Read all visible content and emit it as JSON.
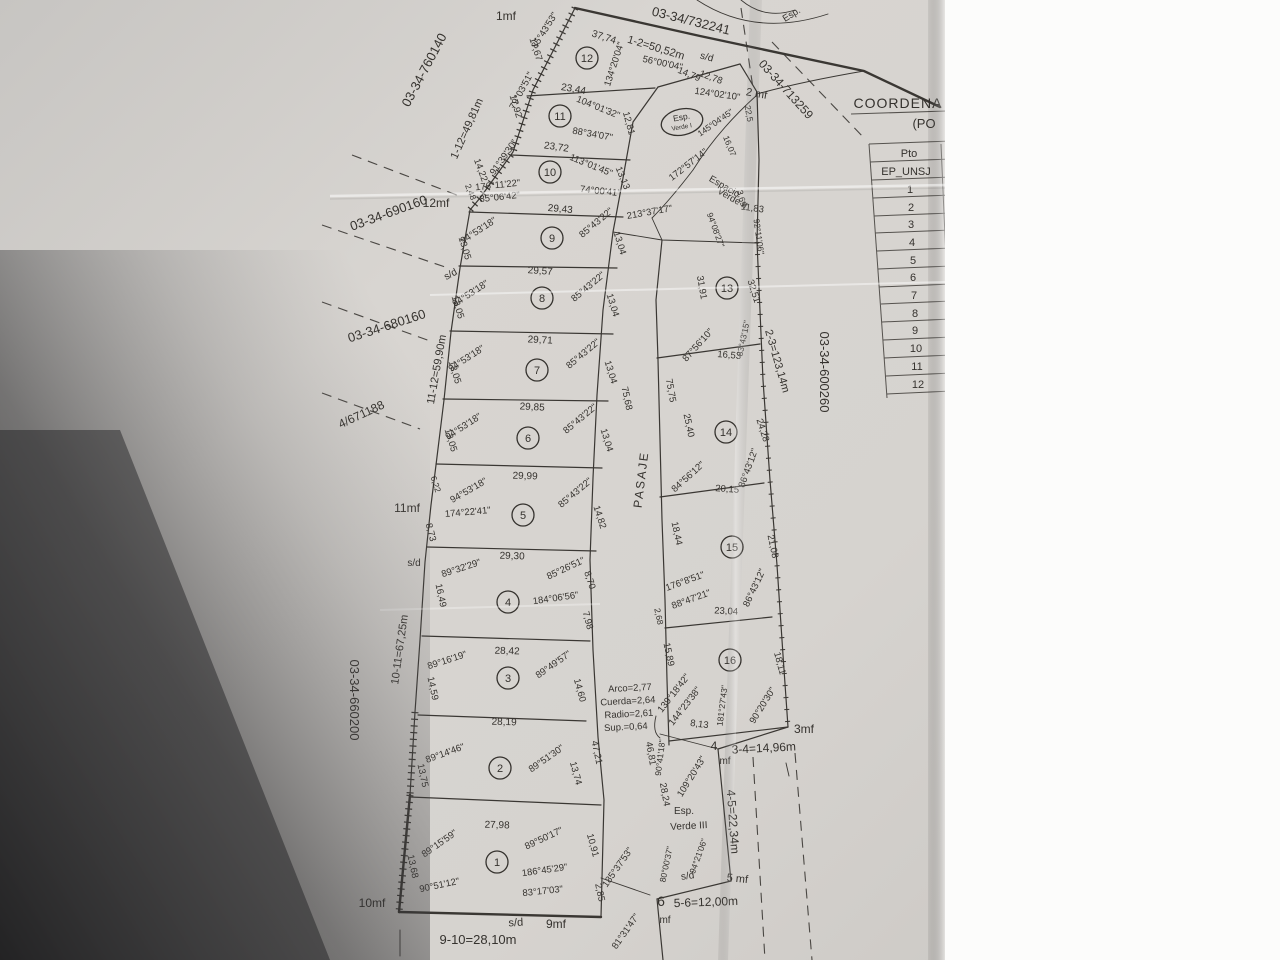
{
  "misc": {
    "sd": "s/d",
    "coord_title": "COORDENA",
    "coord_sub": "(PO",
    "pasaje": "PASAJE"
  },
  "parcels": {
    "top": "03-34/732241",
    "top_left": "03-34-760140",
    "left_a": "03-34-690160",
    "left_b": "03-34-680160",
    "left_c": "4/671188",
    "left_d": "03-34-660200",
    "right_a": "03-34-713259",
    "right_b": "03-34-600260"
  },
  "perimeter": {
    "s1_2": "1-2=50,52m",
    "s1_12": "1-12=49,81m",
    "s11_12": "11-12=59,90m",
    "s10_11": "10-11=67,25m",
    "s9_10": "9-10=28,10m",
    "s2_3": "2-3=123,14m",
    "s3_4": "3-4=14,96m",
    "s4_5": "4-5=22,34m",
    "s5_6": "5-6=12,00m"
  },
  "markers": {
    "m1": "1mf",
    "m2": "2 mf",
    "m3": "3mf",
    "m4a": "4",
    "m4b": "mf",
    "m5": "5 mf",
    "m6a": "6",
    "m6b": "mf",
    "m9": "9mf",
    "m10": "10mf",
    "m11": "11mf",
    "m12": "12mf"
  },
  "table": {
    "col": "Pto",
    "rows": [
      "EP_UNSJ",
      "1",
      "2",
      "3",
      "4",
      "5",
      "6",
      "7",
      "8",
      "9",
      "10",
      "11",
      "12"
    ]
  },
  "green": {
    "g1a": "Esp.",
    "g1b": "Verde I",
    "g2a": "Espacio",
    "g2b": "Verde II",
    "g3a": "Esp.",
    "g3b": "Verde III"
  },
  "arc": {
    "l1": "Arco=2,77",
    "l2": "Cuerda=2,64",
    "l3": "Radio=2,61",
    "l4": "Sup.=0,64"
  },
  "top": {
    "m3774": "37,74",
    "a56": "56°00'04\"",
    "m1278": "12,78",
    "a124": "124°02'10\"",
    "m1479": "14,79",
    "a134": "134°20'04\"",
    "a85": "85°43'53\"",
    "m1767": "17,67",
    "frag": "Esp."
  },
  "esp2": {
    "a213": "213°37'17\"",
    "m369": "3,69",
    "a94": "94°08'27\"",
    "m1183": "11,83",
    "a92": "92°11'06\"",
    "a172": "172°57'14\"",
    "m1607": "16,07",
    "a145": "145°04'45\"",
    "m225": "22,5"
  },
  "pasaje_m": {
    "m7568": "75,68",
    "m7575": "75,75",
    "m4721": "47,21",
    "m4681": "46,81"
  },
  "bottom_mid": {
    "a9041": "90°41'18\"",
    "m2824": "28,24",
    "a109": "109°20'43\"",
    "a80": "80°00'37\"",
    "a9421": "94°21'06\"",
    "a185": "185°37'53\"",
    "a81": "81°31'47\""
  },
  "lots": {
    "1": {
      "n": "1",
      "top": "27,98",
      "a1": "89°15'59\"",
      "a2": "89°50'17\"",
      "a3": "90°51'12\"",
      "a4": "186°45'29\"",
      "a5": "83°17'03\"",
      "left": "13,68",
      "r1": "10,91",
      "r2": "2,85"
    },
    "2": {
      "n": "2",
      "top": "28,19",
      "a1": "89°14'46\"",
      "a2": "89°51'30\"",
      "left": "13,75",
      "right": "13,74"
    },
    "3": {
      "n": "3",
      "top": "28,42",
      "a1": "89°16'19\"",
      "a2": "89°49'57\"",
      "left": "14,59",
      "right": "14,60"
    },
    "4": {
      "n": "4",
      "top": "29,30",
      "a1": "89°32'29\"",
      "a2": "85°26'51\"",
      "a3": "184°06'56\"",
      "left": "16,49",
      "r1": "8,70",
      "r2": "7,98"
    },
    "5": {
      "n": "5",
      "top": "29,99",
      "a1": "94°53'18\"",
      "a2": "174°22'41\"",
      "a3": "85°43'22\"",
      "l1": "6,22",
      "l2": "8,73",
      "right": "14,82"
    },
    "6": {
      "n": "6",
      "top": "29,85",
      "a1": "94°53'18\"",
      "a2": "85°43'22\"",
      "left": "13,05",
      "right": "13,04"
    },
    "7": {
      "n": "7",
      "top": "29,71",
      "a1": "94°53'18\"",
      "a2": "85°43'22\"",
      "left": "13,05",
      "right": "13,04"
    },
    "8": {
      "n": "8",
      "top": "29,57",
      "a1": "94°53'18\"",
      "a2": "85°43'22\"",
      "left": "13,05",
      "right": "13,04"
    },
    "9": {
      "n": "9",
      "top": "29,43",
      "a1": "94°53'18\"",
      "a2": "85°43'22\"",
      "left": "13,05",
      "right": "13,04"
    },
    "10": {
      "n": "10",
      "top": "23,72",
      "a1": "113°01'45\"",
      "a2": "176°11'22\"",
      "a3": "85°06'42\"",
      "a4": "74°00'41\"",
      "a5": "91°39'30\"",
      "left": "14,22",
      "l2": "2,48",
      "right": "13,13"
    },
    "11": {
      "n": "11",
      "top": "23,44",
      "a1": "104°01'32\"",
      "a2": "88°34'07\"",
      "a3": "79°03'51\"",
      "left": "17,92",
      "right": "12,81"
    },
    "12": {
      "n": "12"
    },
    "13": {
      "n": "13",
      "left": "31,91",
      "right": "32,51",
      "a1": "87°56'10\"",
      "a2": "83°43'15\"",
      "bottom": "16,53"
    },
    "14": {
      "n": "14",
      "left": "25,40",
      "right": "24,28",
      "a1": "84°56'12\"",
      "a2": "86°43'12\"",
      "bottom": "20,15"
    },
    "15": {
      "n": "15",
      "left": "18,44",
      "l2": "2,68",
      "right": "21,08",
      "a1": "176°8'51\"",
      "a2": "88°47'21\"",
      "a3": "86°43'12\"",
      "bottom": "23,04"
    },
    "16": {
      "n": "16",
      "left": "15,89",
      "a1": "139°18'42\"",
      "a2": "144°23'38\"",
      "b": "8,13",
      "a3": "181°27'43\"",
      "a4": "90°20'30\"",
      "right": "18,11"
    }
  }
}
